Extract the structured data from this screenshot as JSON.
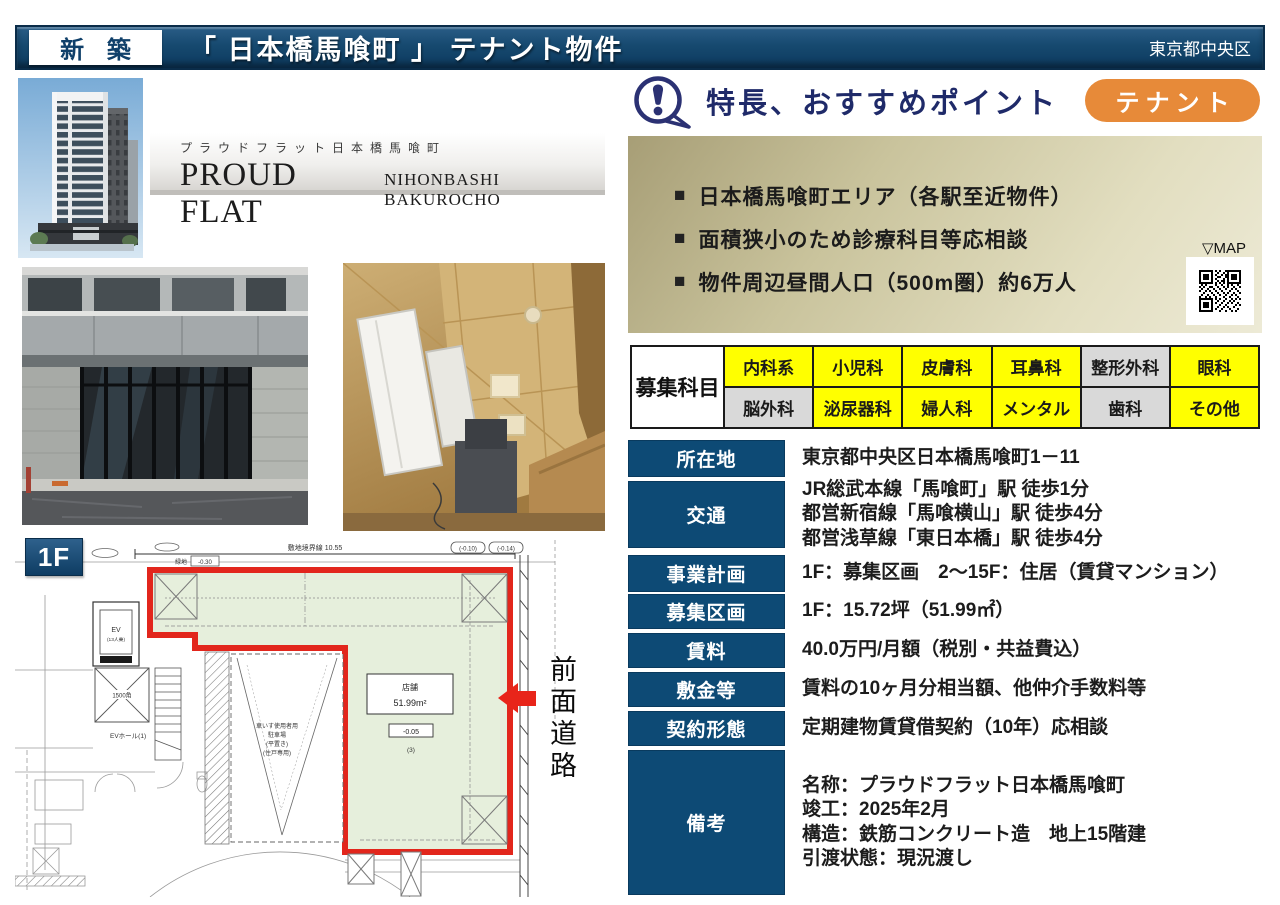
{
  "header": {
    "badge": "新 築",
    "title": "「 日本橋馬喰町 」 テナント物件",
    "area": "東京都中央区"
  },
  "brand": {
    "kana": "プラウドフラット日本橋馬喰町",
    "name": "PROUD FLAT",
    "subname": "NIHONBASHI BAKUROCHO"
  },
  "feature": {
    "title": "特長、おすすめポイント",
    "tag": "テナント",
    "bullet_marker": "■",
    "bullets": [
      "日本橋馬喰町エリア（各駅至近物件）",
      "面積狭小のため診療科目等応相談",
      "物件周辺昼間人口（500m圏）約6万人"
    ],
    "map_label": "▽MAP"
  },
  "departments": {
    "label": "募集科目",
    "rows": [
      [
        {
          "label": "内科系",
          "active": true
        },
        {
          "label": "小児科",
          "active": true
        },
        {
          "label": "皮膚科",
          "active": true
        },
        {
          "label": "耳鼻科",
          "active": true
        },
        {
          "label": "整形外科",
          "active": false
        },
        {
          "label": "眼科",
          "active": true
        }
      ],
      [
        {
          "label": "脳外科",
          "active": false
        },
        {
          "label": "泌尿器科",
          "active": true
        },
        {
          "label": "婦人科",
          "active": true
        },
        {
          "label": "メンタル",
          "active": true
        },
        {
          "label": "歯科",
          "active": false
        },
        {
          "label": "その他",
          "active": true
        }
      ]
    ]
  },
  "details": [
    {
      "label": "所在地",
      "value": "東京都中央区日本橋馬喰町1－11"
    },
    {
      "label": "交通",
      "value": "JR総武本線「馬喰町」駅 徒歩1分\n都営新宿線「馬喰横山」駅 徒歩4分\n都営浅草線「東日本橋」駅 徒歩4分"
    },
    {
      "label": "事業計画",
      "value": "1F：募集区画　2～15F：住居（賃貸マンション）"
    },
    {
      "label": "募集区画",
      "value": "1F：15.72坪（51.99㎡）"
    },
    {
      "label": "賃料",
      "value": "40.0万円/月額（税別・共益費込）"
    },
    {
      "label": "敷金等",
      "value": "賃料の10ヶ月分相当額、他仲介手数料等"
    },
    {
      "label": "契約形態",
      "value": "定期建物賃貸借契約（10年）応相談"
    },
    {
      "label": "備考",
      "value": "名称：プラウドフラット日本橋馬喰町\n竣工：2025年2月\n構造：鉄筋コンクリート造　地上15階建\n引渡状態：現況渡し"
    }
  ],
  "plan": {
    "floor": "1F",
    "road": "前面道路",
    "boundary": "敷地境界線 10.55",
    "level_a": "(-0.10)",
    "level_b": "(-0.14)",
    "green": "緑地",
    "green_level": "-0.30",
    "ev": "EV",
    "ev_cap": "(13人乗)",
    "ev_hall": "EVホール(1)",
    "column": "1500角",
    "parking1": "車いす使用者用",
    "parking2": "駐車場",
    "parking3": "(平置き)",
    "parking4": "(住戸専用)",
    "store": "店舗",
    "store_area": "51.99m²",
    "store_level": "-0.05",
    "store_no": "(3)"
  },
  "colors": {
    "navy": "#0d4a75",
    "orange": "#e78a39",
    "yellow": "#ffff00",
    "gray": "#d9d9d9",
    "red": "#e2261c",
    "green_fill": "#e6efdc"
  }
}
